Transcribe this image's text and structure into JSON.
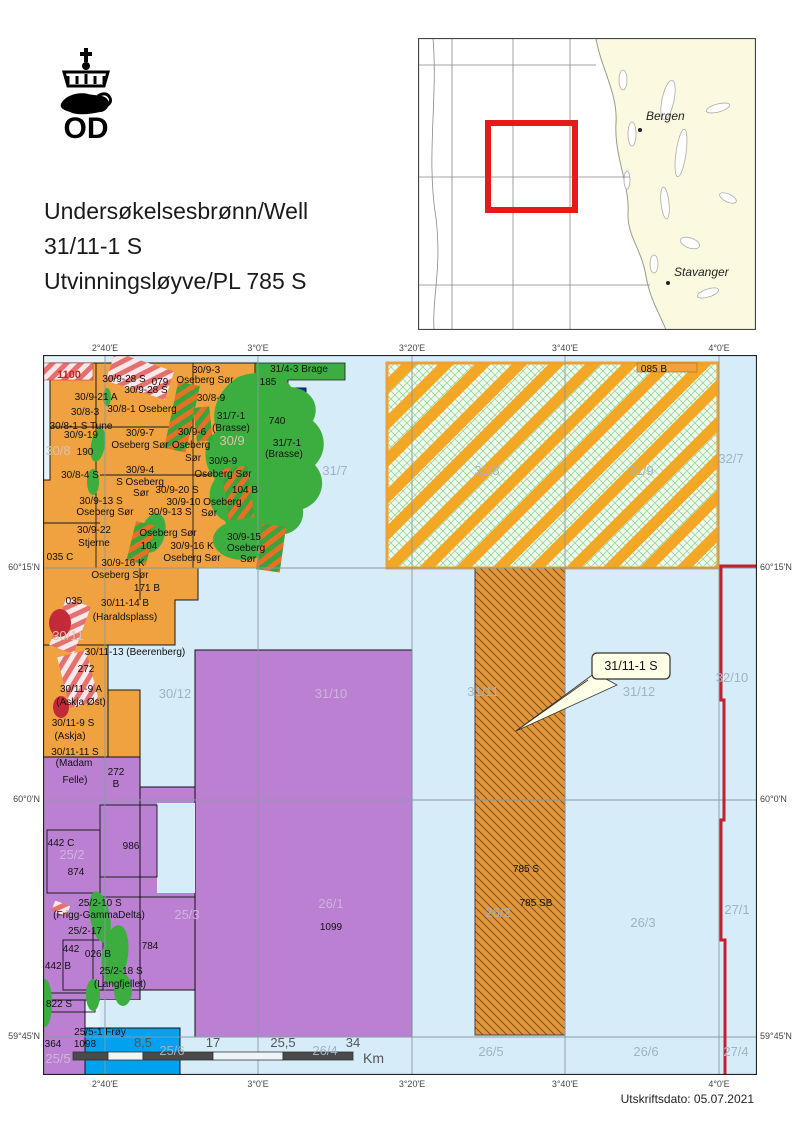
{
  "header": {
    "logo_text": "OD",
    "title_lines": [
      "Undersøkelsesbrønn/Well",
      "31/11-1 S",
      "Utvinningsløyve/PL 785 S"
    ]
  },
  "inset": {
    "cities": [
      {
        "name": "Bergen"
      },
      {
        "name": "Stavanger"
      }
    ]
  },
  "map": {
    "lon_labels": [
      "2°40'E",
      "3°0'E",
      "3°20'E",
      "3°40'E",
      "4°0'E"
    ],
    "lat_labels": [
      "60°15'N",
      "60°0'N",
      "59°45'N"
    ],
    "callout": {
      "label": "31/11-1 S"
    },
    "scalebar": {
      "ticks": [
        "8,5",
        "17",
        "25,5",
        "34"
      ],
      "unit": "Km"
    },
    "labels": [
      [
        "1100",
        26,
        23,
        "r"
      ],
      [
        "30/9-28 S",
        81,
        27,
        "b"
      ],
      [
        "079",
        117,
        30,
        "b"
      ],
      [
        "30/9-28 S",
        103,
        38,
        "b"
      ],
      [
        "30/9-3",
        163,
        18,
        "b"
      ],
      [
        "Oseberg Sør",
        162,
        28,
        "b"
      ],
      [
        "30/9-21 A",
        53,
        45,
        "b"
      ],
      [
        "30/8-3",
        42,
        60,
        "b"
      ],
      [
        "30/8-1 Oseberg",
        99,
        57,
        "b"
      ],
      [
        "30/8-9",
        168,
        46,
        "b"
      ],
      [
        "30/8-1 S Tune",
        38,
        74,
        "b"
      ],
      [
        "30/9-19",
        38,
        83,
        "b"
      ],
      [
        "31/7-1",
        188,
        64,
        "b"
      ],
      [
        "(Brasse)",
        188,
        76,
        "b"
      ],
      [
        "30/9-7",
        97,
        81,
        "b"
      ],
      [
        "Oseberg Sør",
        97,
        93,
        "b"
      ],
      [
        "30/9-6",
        149,
        80,
        "b"
      ],
      [
        "Oseberg",
        148,
        93,
        "b"
      ],
      [
        "Sør",
        150,
        106,
        "b"
      ],
      [
        "190",
        42,
        100,
        "b"
      ],
      [
        "30/9-9",
        180,
        109,
        "b"
      ],
      [
        "Oseberg Sør",
        180,
        122,
        "b"
      ],
      [
        "30/8-4 S",
        37,
        123,
        "b"
      ],
      [
        "30/9-4",
        97,
        118,
        "b"
      ],
      [
        "S Oseberg",
        97,
        130,
        "b"
      ],
      [
        "Sør",
        98,
        141,
        "b"
      ],
      [
        "30/9-20 S",
        134,
        138,
        "b"
      ],
      [
        "104 B",
        202,
        138,
        "b"
      ],
      [
        "30/9-10 Oseberg",
        161,
        150,
        "b"
      ],
      [
        "Sør",
        166,
        161,
        "b"
      ],
      [
        "30/9-13 S",
        58,
        149,
        "b"
      ],
      [
        "Oseberg Sør",
        62,
        160,
        "b"
      ],
      [
        "30/9-13 S",
        127,
        160,
        "b"
      ],
      [
        "Oseberg Sør",
        125,
        181,
        "b"
      ],
      [
        "30/9-15",
        201,
        185,
        "b"
      ],
      [
        "Oseberg",
        203,
        196,
        "b"
      ],
      [
        "Sør",
        205,
        207,
        "b"
      ],
      [
        "30/9-22",
        51,
        178,
        "b"
      ],
      [
        "Stjerne",
        51,
        191,
        "b"
      ],
      [
        "035 C",
        17,
        205,
        "b"
      ],
      [
        "104",
        106,
        194,
        "b"
      ],
      [
        "30/9-16 K",
        149,
        194,
        "b"
      ],
      [
        "Oseberg Sør",
        149,
        206,
        "b"
      ],
      [
        "30/9-16 K",
        80,
        211,
        "b"
      ],
      [
        "Oseberg Sør",
        77,
        223,
        "b"
      ],
      [
        "171 B",
        104,
        236,
        "b"
      ],
      [
        "035",
        31,
        249,
        "b"
      ],
      [
        "30/11-14 B",
        82,
        251,
        "b"
      ],
      [
        "(Haraldsplass)",
        82,
        265,
        "b"
      ],
      [
        "30/11-13 (Beerenberg)",
        92,
        300,
        "b"
      ],
      [
        "272",
        43,
        317,
        "b"
      ],
      [
        "30/11-9 A",
        38,
        337,
        "b"
      ],
      [
        "(Askja Øst)",
        38,
        350,
        "b"
      ],
      [
        "30/11-9 S",
        30,
        371,
        "b"
      ],
      [
        "(Askja)",
        27,
        384,
        "b"
      ],
      [
        "30/11-11 S",
        32,
        400,
        "b"
      ],
      [
        "(Madam",
        31,
        411,
        "b"
      ],
      [
        "Felle)",
        32,
        428,
        "b"
      ],
      [
        "272",
        73,
        420,
        "b"
      ],
      [
        "B",
        73,
        432,
        "b"
      ],
      [
        "31/4-3 Brage",
        256,
        17,
        "b"
      ],
      [
        "185",
        225,
        30,
        "b"
      ],
      [
        "740",
        234,
        69,
        "b"
      ],
      [
        "31/7-1",
        244,
        91,
        "b"
      ],
      [
        "(Brasse)",
        241,
        102,
        "b"
      ],
      [
        "085 B",
        611,
        17,
        "b"
      ],
      [
        "785 S",
        483,
        517,
        "b"
      ],
      [
        "785 SB",
        493,
        551,
        "b"
      ],
      [
        "442 C",
        18,
        491,
        "b"
      ],
      [
        "874",
        33,
        520,
        "b"
      ],
      [
        "986",
        88,
        494,
        "b"
      ],
      [
        "25/2-10 S",
        57,
        551,
        "b"
      ],
      [
        "(Frigg-GammaDelta)",
        56,
        563,
        "b"
      ],
      [
        "25/2-17",
        42,
        579,
        "b"
      ],
      [
        "442",
        28,
        597,
        "b"
      ],
      [
        "026 B",
        55,
        602,
        "b"
      ],
      [
        "442 B",
        15,
        614,
        "b"
      ],
      [
        "25/2-18 S",
        78,
        619,
        "b"
      ],
      [
        "(Langfjellet)",
        77,
        632,
        "b"
      ],
      [
        "784",
        107,
        594,
        "b"
      ],
      [
        "822 S",
        16,
        652,
        "b"
      ],
      [
        "25/5-1 Frøy",
        57,
        680,
        "b"
      ],
      [
        "364",
        10,
        692,
        "b"
      ],
      [
        "1098",
        42,
        692,
        "b"
      ],
      [
        "1099",
        288,
        575,
        "b"
      ],
      [
        "30/8",
        15,
        100,
        "qh"
      ],
      [
        "30/9",
        189,
        90,
        "qh"
      ],
      [
        "31/7",
        292,
        120,
        "q"
      ],
      [
        "31/8",
        444,
        120,
        "q"
      ],
      [
        "31/9",
        598,
        120,
        "q"
      ],
      [
        "32/7",
        688,
        108,
        "q"
      ],
      [
        "30/11",
        25,
        285,
        "qh"
      ],
      [
        "30/12",
        132,
        343,
        "q"
      ],
      [
        "31/10",
        288,
        343,
        "qp"
      ],
      [
        "31/11",
        440,
        341,
        "q"
      ],
      [
        "31/12",
        596,
        341,
        "q"
      ],
      [
        "32/10",
        689,
        327,
        "q"
      ],
      [
        "25/2",
        29,
        504,
        "qp"
      ],
      [
        "25/3",
        144,
        564,
        "qp"
      ],
      [
        "26/1",
        288,
        553,
        "qp"
      ],
      [
        "26/2",
        455,
        562,
        "q"
      ],
      [
        "26/3",
        600,
        572,
        "q"
      ],
      [
        "27/1",
        694,
        559,
        "q"
      ],
      [
        "25/5",
        15,
        708,
        "qp"
      ],
      [
        "25/6",
        129,
        700,
        "q"
      ],
      [
        "26/4",
        282,
        700,
        "q"
      ],
      [
        "26/5",
        448,
        701,
        "q"
      ],
      [
        "26/6",
        603,
        701,
        "q"
      ],
      [
        "27/4",
        693,
        701,
        "q"
      ]
    ]
  },
  "footer": {
    "print_date": "Utskriftsdato: 05.07.2021"
  },
  "colors": {
    "sea": "#d6ecf8",
    "sea_light": "#e7f3fb",
    "license_orange": "#f0a240",
    "field_green": "#3cae3f",
    "field_red": "#c22a3a",
    "navy_block": "#18339b",
    "license_purple": "#bb80d2",
    "bright_blue": "#00a2ef",
    "hatch_mint": "#eef8ec",
    "hatch_orange_stripe": "#f4a625",
    "strip_785": "#e3953c",
    "boundary_red": "#c41f2f",
    "callout_bg": "#ffffe8",
    "inset_land": "#fbf9e0",
    "inset_red_frame": "#e51a1a"
  }
}
